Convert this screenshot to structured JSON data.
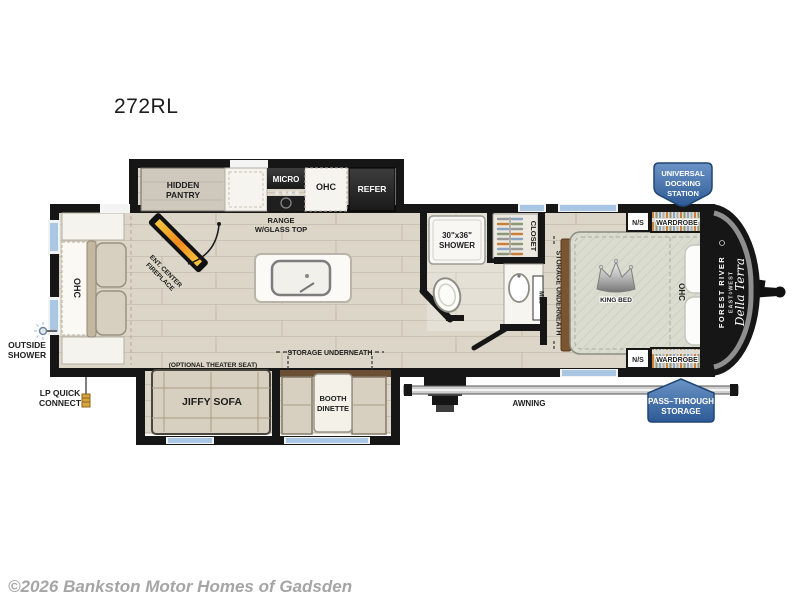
{
  "title": "272RL",
  "copyright": "©2026 Bankston Motor Homes of Gadsden",
  "colors": {
    "wall": "#161616",
    "floor": "#dcd6c8",
    "badge_blue_light": "#6b94c6",
    "badge_blue_dark": "#2d5a96",
    "window_blue": "#a9c6e3",
    "tan": "#d7cfbf",
    "wood_brown": "#7b5431",
    "flame_orange": "#f59a23"
  },
  "badges": {
    "docking": {
      "line1": "UNIVERSAL",
      "line2": "DOCKING",
      "line3": "STATION"
    },
    "pass_through": {
      "line1": "PASS–THROUGH",
      "line2": "STORAGE"
    }
  },
  "branding": {
    "make": "FOREST RIVER",
    "series": "EAST◊WEST",
    "model": "Della Terra"
  },
  "kitchen": {
    "pantry_line1": "HIDDEN",
    "pantry_line2": "PANTRY",
    "micro": "MICRO",
    "ohc": "OHC",
    "refer": "REFER",
    "range_line1": "RANGE",
    "range_line2": "W/GLASS TOP"
  },
  "bath": {
    "shower_line1": "30\"x36\"",
    "shower_line2": "SHOWER",
    "closet": "CLOSET",
    "med": "MED"
  },
  "bedroom": {
    "king_bed": "KING BED",
    "ohc": "OHC",
    "ns_top": "N/S",
    "wardrobe_top": "WARDROBE",
    "ns_bottom": "N/S",
    "wardrobe_bottom": "WARDROBE",
    "storage": "STORAGE UNDERNEATH"
  },
  "living": {
    "ohc": "OHC",
    "fireplace_line1": "ENT. CENTER",
    "fireplace_line2": "FIREPLACE",
    "theater": "(OPTIONAL THEATER SEAT)",
    "jiffy": "JIFFY SOFA",
    "booth_line1": "BOOTH",
    "booth_line2": "DINETTE",
    "storage": "STORAGE UNDERNEATH"
  },
  "exterior": {
    "awning": "AWNING",
    "outside_shower_line1": "OUTSIDE",
    "outside_shower_line2": "SHOWER",
    "lp_line1": "LP QUICK",
    "lp_line2": "CONNECT"
  }
}
